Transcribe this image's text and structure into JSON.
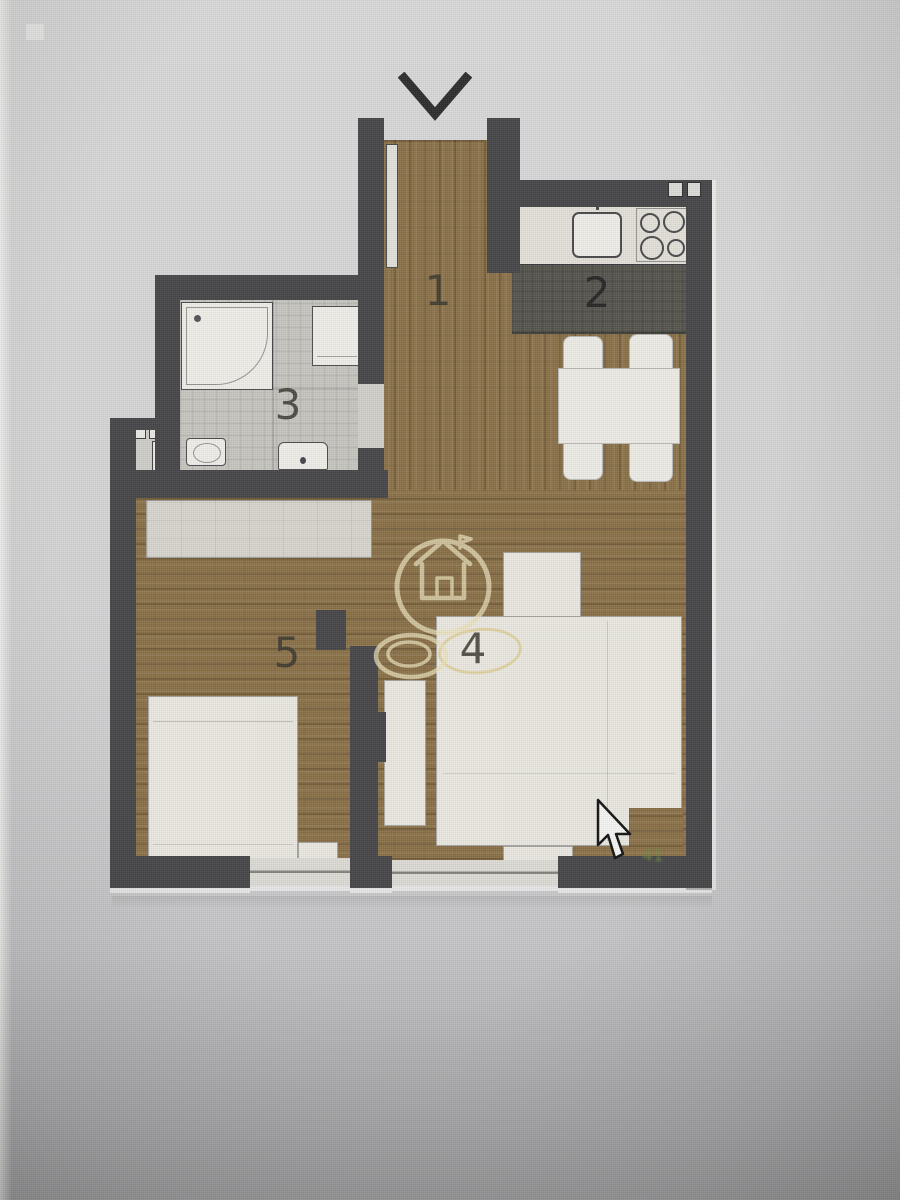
{
  "rooms": [
    {
      "label": "1"
    },
    {
      "label": "2"
    },
    {
      "label": "3"
    },
    {
      "label": "4"
    },
    {
      "label": "5"
    }
  ],
  "marks": {
    "green_text": "41"
  },
  "icons": {
    "entrance": "chevron-down-arrow",
    "watermark": "house-in-circle-logo",
    "pointer": "mouse-cursor-arrow",
    "kitchen_sink": "sink-basin",
    "kitchen_stove": "four-burner-hob",
    "bathroom_shower": "shower-tray",
    "bathroom_washer": "washing-machine",
    "bathroom_sink": "washbasin",
    "bathroom_toilet": "toilet"
  },
  "colors": {
    "wall": "#47474a",
    "wood_floor": "#8b7249",
    "bathroom_tile": "#c7c6c1",
    "kitchen_floor": "#57564f",
    "furniture": "#eae8e1",
    "background": "#d4d4d5",
    "watermark": "#ece2bd",
    "green_mark": "#6d8a45"
  }
}
